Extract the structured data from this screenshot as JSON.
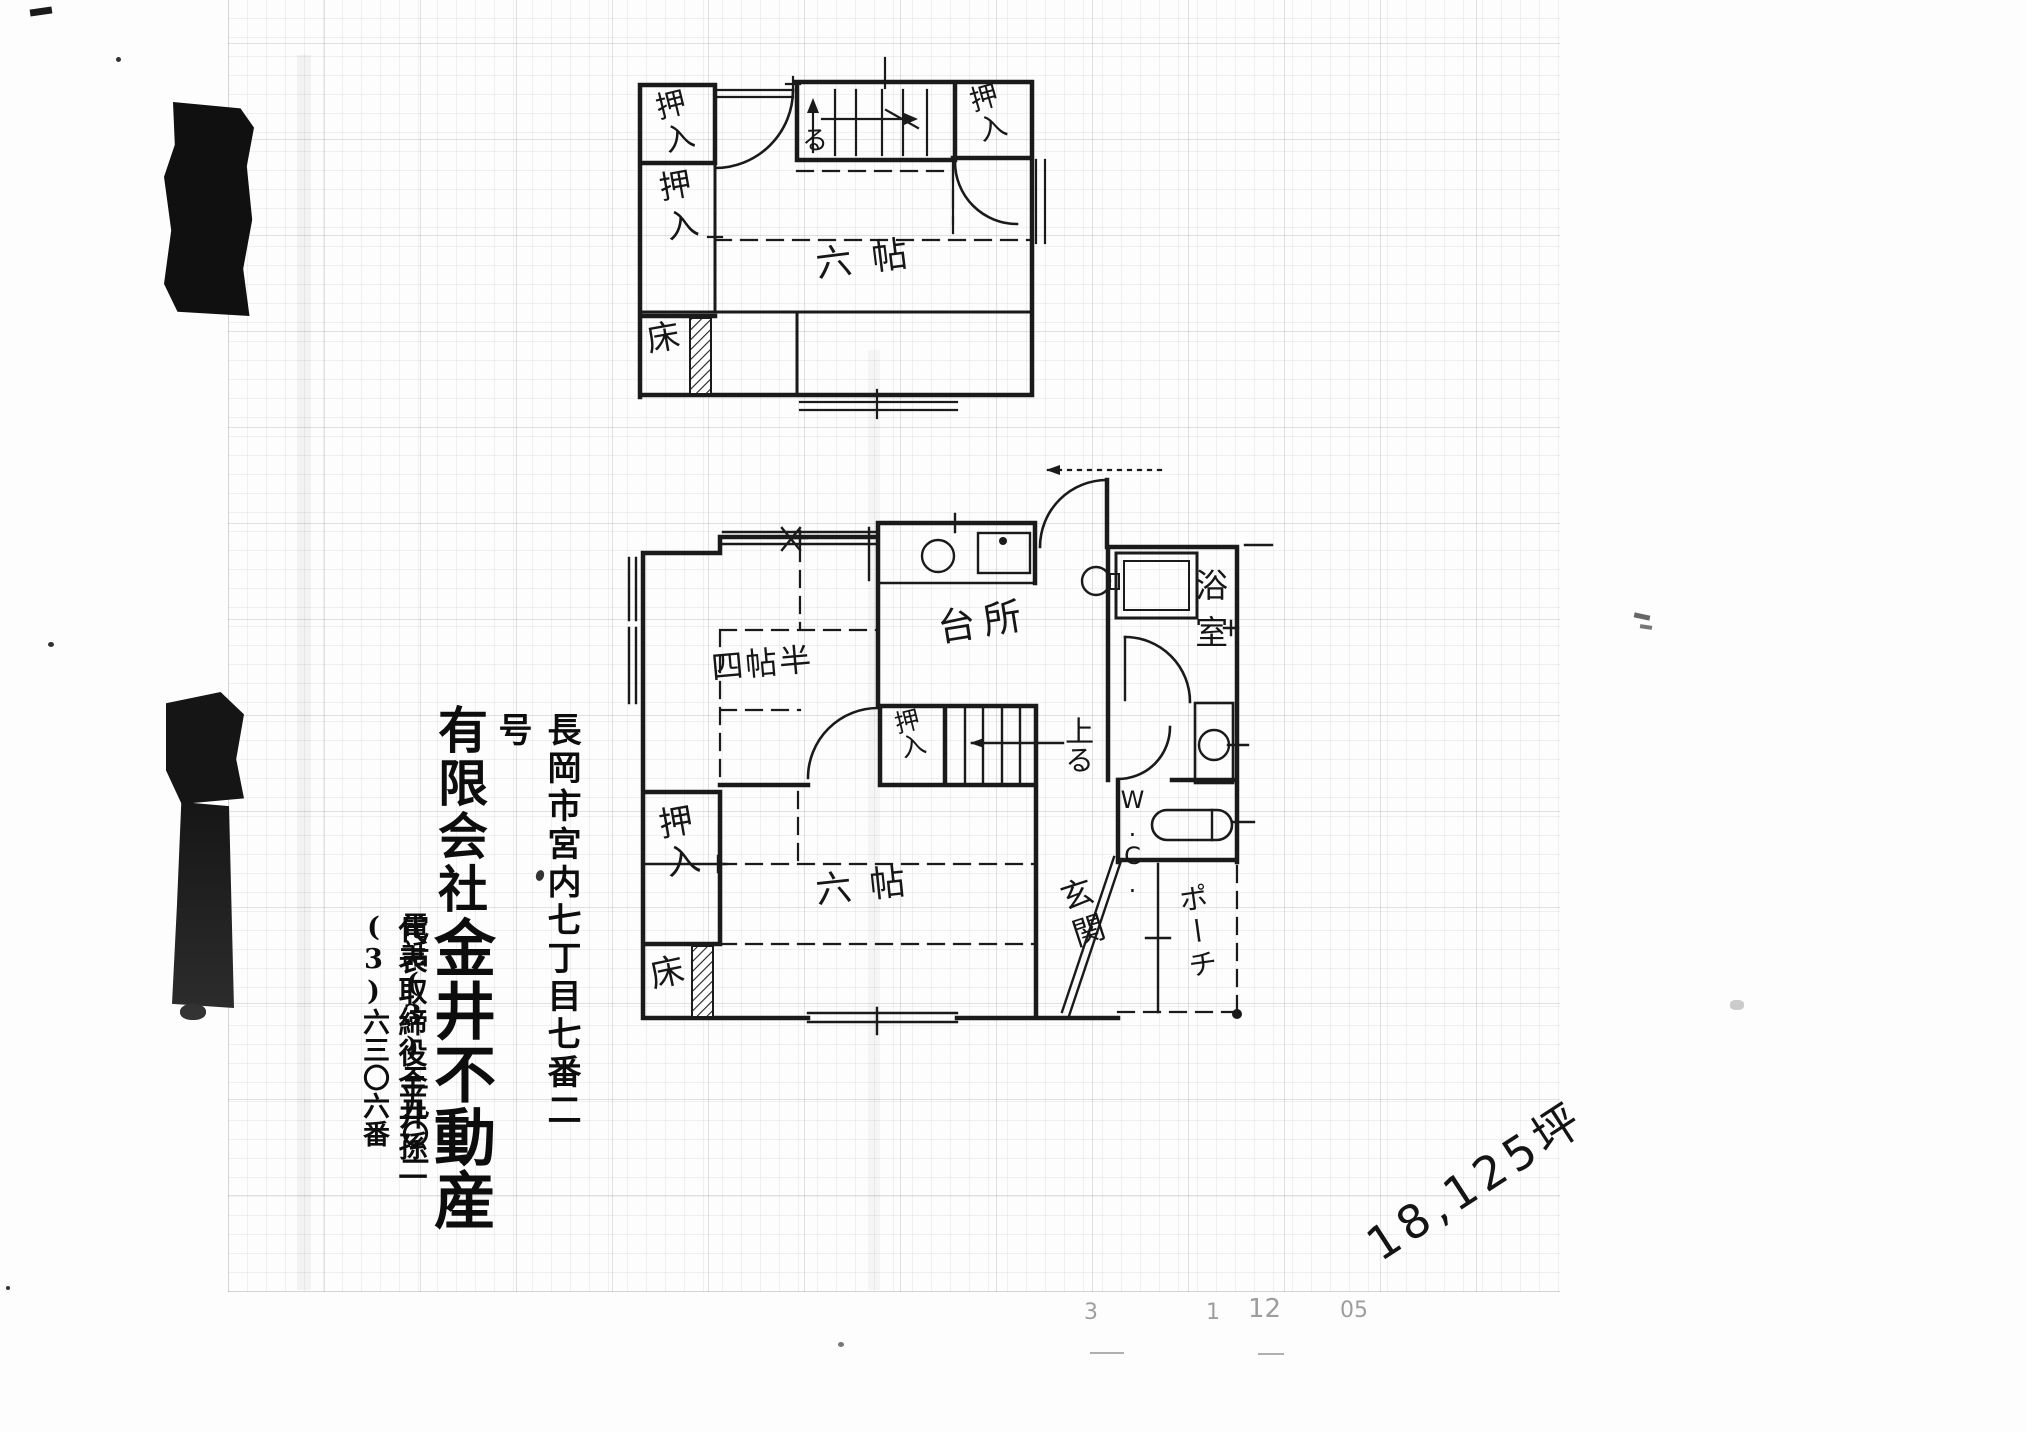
{
  "colors": {
    "ink": "#1a1a1a",
    "paper": "#fdfdfd",
    "grid_line": "#8d93a0"
  },
  "company_block": {
    "address": "長岡市宮内七丁目七番二号",
    "company_prefix": "有限会社",
    "company_name": "金井不動産",
    "representative": "代表取締役金井孫一",
    "phone": "電話(3)三九〇一(3)六三〇六番"
  },
  "annotations": {
    "area_note": "18,125坪",
    "faint_marks": [
      "3",
      "1",
      "12",
      "05"
    ]
  },
  "floor_plan": {
    "second_floor": {
      "closet_top_left": "押入",
      "closet_left": "押入",
      "closet_top_right": "押入",
      "tokonoma": "床",
      "room_six_tatami": "六帖",
      "stairs_up": "る"
    },
    "first_floor": {
      "room_four_half_tatami": "四帖半",
      "kitchen": "台所",
      "bathroom": "浴室",
      "toilet": "W.C.",
      "closet_west": "押入",
      "closet_stairs": "押入",
      "tokonoma": "床",
      "room_six_tatami": "六帖",
      "entrance": "玄関",
      "porch": "ポーチ",
      "stairs_up": "上る"
    }
  }
}
